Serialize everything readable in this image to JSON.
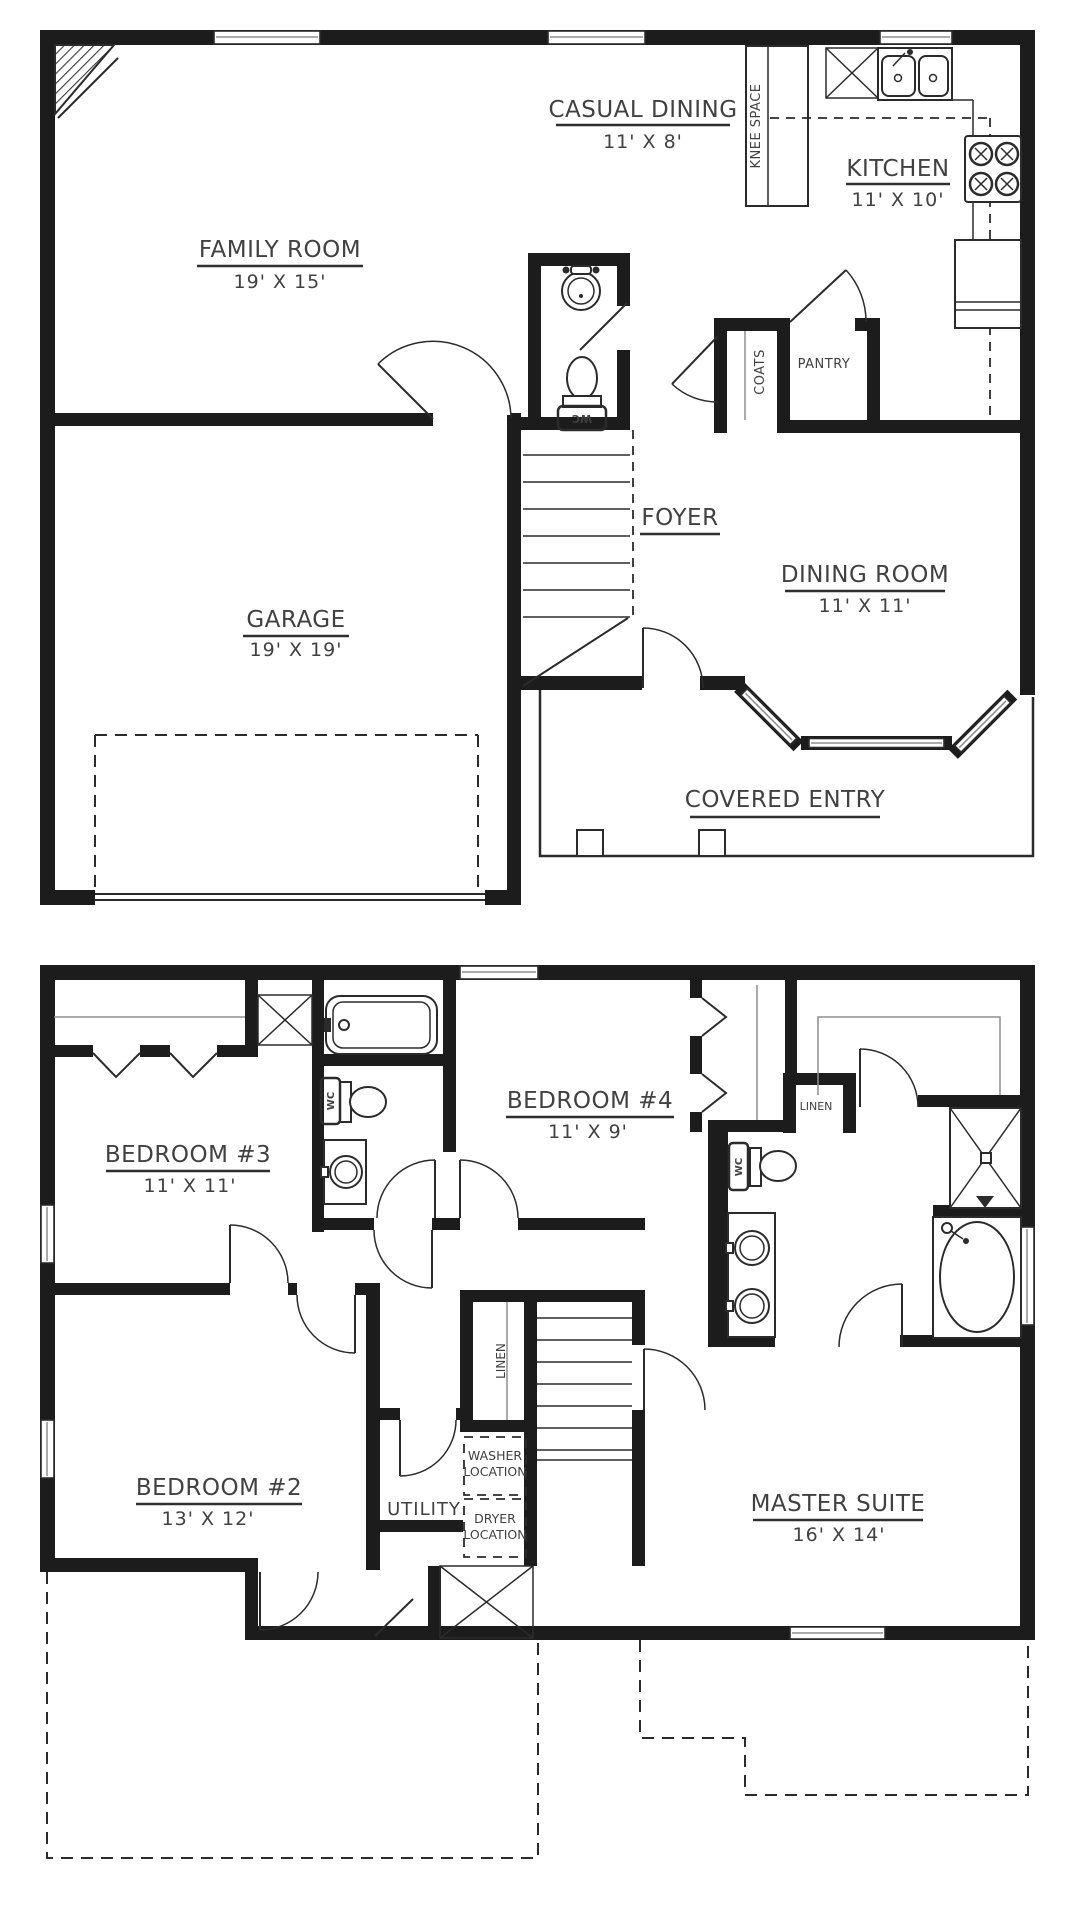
{
  "colors": {
    "wall": "#1c1c1c",
    "line": "#2b2b2b",
    "text": "#414141",
    "background": "#ffffff"
  },
  "floors": {
    "first": {
      "rooms": {
        "casual_dining": {
          "name": "CASUAL DINING",
          "dims": "11' X 8'"
        },
        "kitchen": {
          "name": "KITCHEN",
          "dims": "11' X 10'"
        },
        "family_room": {
          "name": "FAMILY ROOM",
          "dims": "19' X 15'"
        },
        "foyer": {
          "name": "FOYER",
          "dims": ""
        },
        "dining_room": {
          "name": "DINING ROOM",
          "dims": "11' X 11'"
        },
        "garage": {
          "name": "GARAGE",
          "dims": "19' X 19'"
        },
        "covered_entry": {
          "name": "COVERED ENTRY",
          "dims": ""
        }
      },
      "annotations": {
        "knee_space": "KNEE SPACE",
        "coats": "COATS",
        "pantry": "PANTRY",
        "wc": "WC"
      }
    },
    "second": {
      "rooms": {
        "bedroom3": {
          "name": "BEDROOM #3",
          "dims": "11' X 11'"
        },
        "bedroom4": {
          "name": "BEDROOM #4",
          "dims": "11' X 9'"
        },
        "bedroom2": {
          "name": "BEDROOM #2",
          "dims": "13' X 12'"
        },
        "master_suite": {
          "name": "MASTER SUITE",
          "dims": "16' X 14'"
        },
        "utility": {
          "name": "UTILITY",
          "dims": ""
        }
      },
      "annotations": {
        "wc_hall": "WC",
        "wc_master": "WC",
        "linen_hall": "LINEN",
        "linen_master": "LINEN",
        "washer_line1": "WASHER",
        "washer_line2": "LOCATION",
        "dryer_line1": "DRYER",
        "dryer_line2": "LOCATION"
      }
    }
  }
}
